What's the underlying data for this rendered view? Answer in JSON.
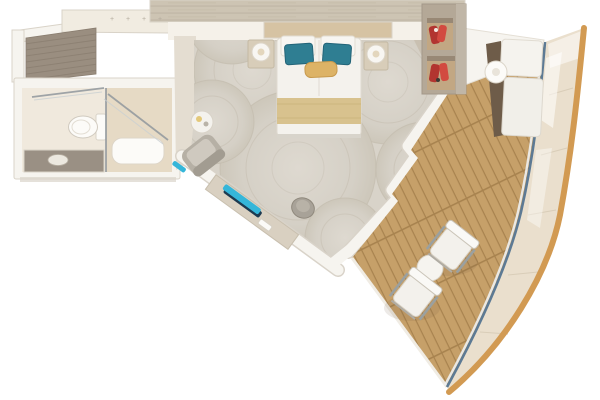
{
  "scene": {
    "type": "floor-plan-render",
    "subject": "cruise-ship-stateroom-with-curved-balcony",
    "view": "top-down"
  },
  "marks": {
    "glyph": "+",
    "count": 4
  },
  "palette": {
    "bg": "#ffffff",
    "wall_white": "#f6f4ef",
    "wall_edge": "#d8d2c7",
    "wall_taupe": "#c9c0b1",
    "bulkhead_cream": "#f1ece1",
    "bulkhead_recess": "#f5f1e9",
    "wood_panel": "#cdc4b3",
    "wood_panel_grain": "#bcb2a0",
    "dark_panel": "#9a8e80",
    "dark_panel_grain": "#8a7e70",
    "bathroom_floor": "#f0e9dd",
    "shower_floor": "#e6dac5",
    "vanity": "#9a9084",
    "fixture_white": "#fcfbf8",
    "entry_floor": "#e4ddd1",
    "carpet_base": "#d8d3c9",
    "carpet_ring": "#c6bfb2",
    "bed_white": "#f4f2ed",
    "headboard": "#d6c3a3",
    "pillow_teal": "#2f7e92",
    "pillow_teal_dark": "#236478",
    "gold": "#ddb366",
    "runner_gold": "#d8c28e",
    "nightstand": "#d8cdb9",
    "chair_gray": "#b6b0a5",
    "chair_gray_light": "#cfc9bf",
    "stool_gray": "#a8a298",
    "desk_wood": "#d9d0c1",
    "teal_accent": "#35b6d9",
    "teal_accent_dark": "#1d3a50",
    "wardrobe_frame": "#b4a897",
    "wardrobe_side": "#c0b6a7",
    "wardrobe_inner": "#c2a783",
    "wardrobe_shadow": "#8d8172",
    "red_item": "#b23530",
    "red_item2": "#d24a40",
    "deck_wood": "#c6a069",
    "deck_gap": "#a8834f",
    "hull_band": "#eadfcd",
    "hull_seam": "#d9cdb8",
    "hull_line": "#d29a52",
    "rail_blue": "#5d7a94",
    "lounger_back": "#6e5c49",
    "white_furniture": "#f5f3ee"
  },
  "objects": [
    "top-bulkhead",
    "entry-closet-panel",
    "bathroom",
    "toilet",
    "vanity",
    "shower",
    "entry-hall",
    "carpet",
    "double-bed",
    "teal-pillows",
    "gold-accent-pillow",
    "gold-bed-runner",
    "nightstand-left",
    "nightstand-right",
    "wardrobe-red-clothes",
    "armchair",
    "side-table",
    "writing-desk",
    "teal-desk-runner",
    "stool",
    "balcony-deck",
    "balcony-lounger",
    "lounger-table",
    "deck-chair-1",
    "deck-chair-2",
    "deck-table",
    "glass-railing",
    "hull-curve"
  ]
}
